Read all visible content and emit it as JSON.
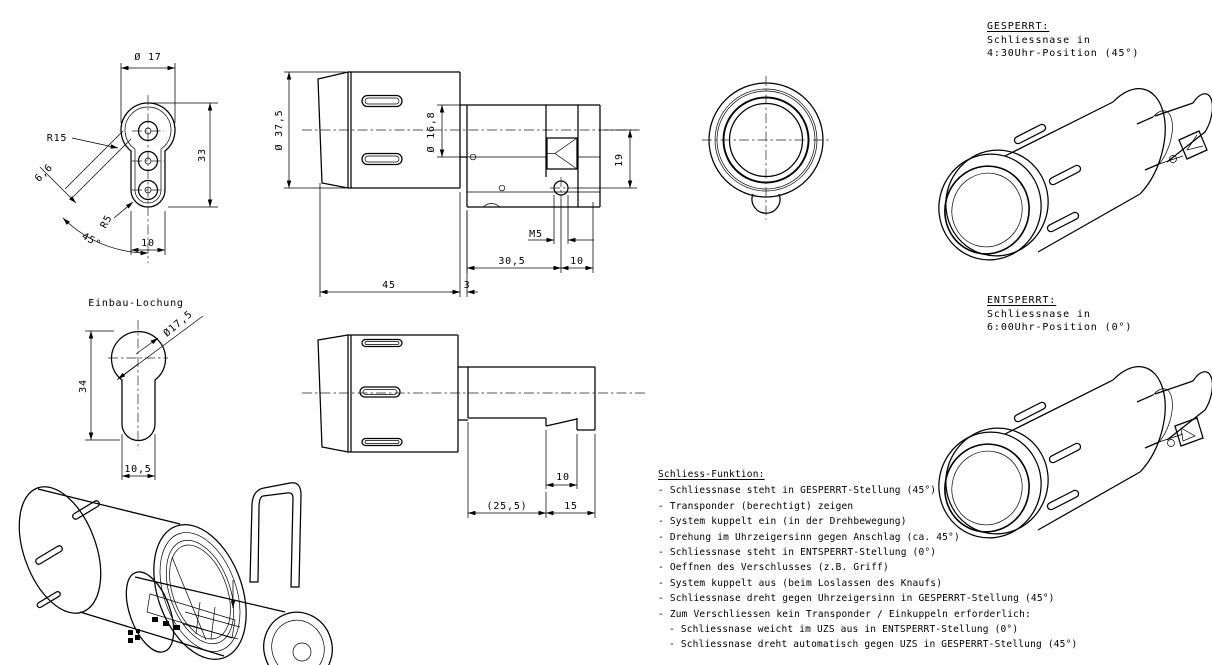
{
  "sheet": {
    "background": "#ffffff",
    "line_color": "#000000"
  },
  "views": {
    "front_profile": {
      "dim_d17": "Ø 17",
      "dim_r15": "R15",
      "dim_66": "6,6",
      "dim_r5": "R5",
      "dim_45deg": "45°",
      "dim_10": "10",
      "dim_33": "33"
    },
    "einbau": {
      "title": "Einbau-Lochung",
      "dim_d175": "Ø17,5",
      "dim_34": "34",
      "dim_105": "10,5"
    },
    "side_top": {
      "dim_d375": "Ø 37,5",
      "dim_d168": "Ø 16,8",
      "dim_19": "19",
      "dim_m5": "M5",
      "dim_305": "30,5",
      "dim_10": "10",
      "dim_45": "45",
      "dim_3": "3"
    },
    "side_bottom": {
      "dim_255": "(25,5)",
      "dim_15": "15",
      "dim_10": "10"
    }
  },
  "notes": {
    "gesperrt": {
      "title": "GESPERRT:",
      "line1": "Schliessnase in",
      "line2": "4:30Uhr-Position (45°)"
    },
    "entsperrt": {
      "title": "ENTSPERRT:",
      "line1": "Schliessnase in",
      "line2": "6:00Uhr-Position (0°)"
    },
    "function": {
      "title": "Schliess-Funktion:",
      "items": [
        "- Schliessnase steht in GESPERRT-Stellung (45°)",
        "- Transponder (berechtigt) zeigen",
        "- System kuppelt ein (in der Drehbewegung)",
        "- Drehung im Uhrzeigersinn gegen Anschlag (ca. 45°)",
        "- Schliessnase steht in ENTSPERRT-Stellung (0°)",
        "- Oeffnen des Verschlusses (z.B. Griff)",
        "- System kuppelt aus (beim Loslassen des Knaufs)",
        "- Schliessnase dreht gegen Uhrzeigersinn in GESPERRT-Stellung (45°)",
        "- Zum Verschliessen kein Transponder / Einkuppeln erforderlich:",
        "- Schliessnase weicht im UZS aus in ENTSPERRT-Stellung (0°)",
        "- Schliessnase dreht automatisch gegen UZS in GESPERRT-Stellung (45°)"
      ]
    }
  }
}
